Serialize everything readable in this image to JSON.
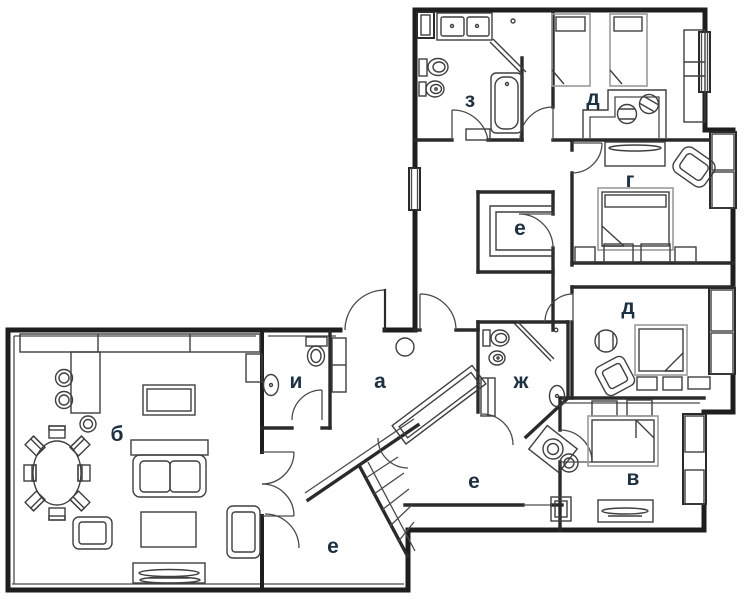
{
  "title": "apartment-floor-plan",
  "colors": {
    "wall": "#1e1e1e",
    "inner_wall": "#2a2a2a",
    "furniture": "#3f3f3f",
    "furniture_light": "#9a9a9a",
    "door": "#4a4a4a",
    "label": "#1c3144",
    "background": "#ffffff"
  },
  "label_font_px": 21,
  "rooms": [
    {
      "id": "living-room",
      "label": "б",
      "x": 117,
      "y": 441
    },
    {
      "id": "wc",
      "label": "и",
      "x": 296,
      "y": 388
    },
    {
      "id": "hall",
      "label": "а",
      "x": 380,
      "y": 388
    },
    {
      "id": "closet-upper",
      "label": "е",
      "x": 520,
      "y": 235
    },
    {
      "id": "corridor",
      "label": "е",
      "x": 474,
      "y": 488
    },
    {
      "id": "closet-lower",
      "label": "е",
      "x": 333,
      "y": 553
    },
    {
      "id": "bathroom-main",
      "label": "ж",
      "x": 521,
      "y": 388
    },
    {
      "id": "bathroom-top",
      "label": "з",
      "x": 470,
      "y": 107
    },
    {
      "id": "kids-bedroom",
      "label": "д",
      "x": 593,
      "y": 105
    },
    {
      "id": "bedroom-middle",
      "label": "д",
      "x": 628,
      "y": 314
    },
    {
      "id": "master-bedroom",
      "label": "г",
      "x": 630,
      "y": 187
    },
    {
      "id": "bedroom-lower",
      "label": "в",
      "x": 633,
      "y": 485
    }
  ]
}
